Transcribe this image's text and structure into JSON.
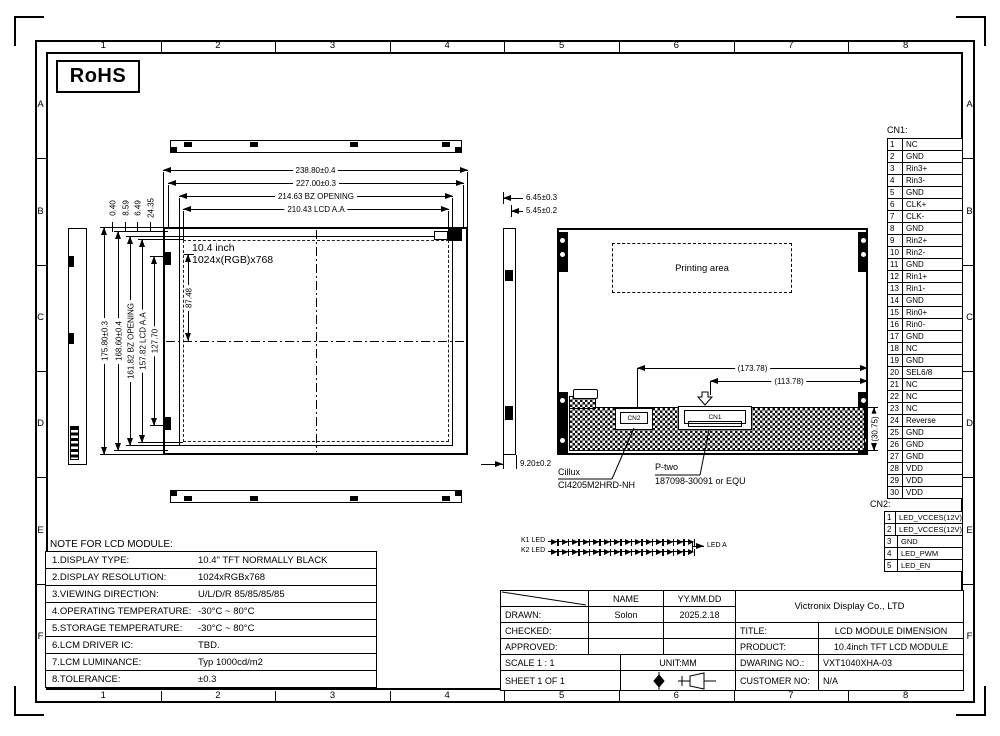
{
  "frame": {
    "cols": [
      "1",
      "2",
      "3",
      "4",
      "5",
      "6",
      "7",
      "8"
    ],
    "rows": [
      "A",
      "B",
      "C",
      "D",
      "E",
      "F"
    ]
  },
  "rohs": "RoHS",
  "front_view": {
    "panel_line1": "10.4 inch",
    "panel_line2": "1024x(RGB)x768",
    "dims_top": [
      "238.80±0.4",
      "227.00±0.3",
      "214.63 BZ OPENING",
      "210.43 LCD A.A"
    ],
    "dims_left": [
      "175.80±0.3",
      "168.60±0.4",
      "161.82 BZ OPENING",
      "157.82 LCD A.A",
      "127.70"
    ],
    "dims_top_small": [
      "0.40",
      "8.59",
      "6.49",
      "24.35"
    ],
    "dim_inner": "87.48"
  },
  "side_view": {
    "dim_top1": "6.45±0.3",
    "dim_top2": "5.45±0.2",
    "dim_bottom": "9.20±0.2"
  },
  "rear_view": {
    "printing_area": "Printing area",
    "dim_cn2": "(173.78)",
    "dim_cn1": "(113.78)",
    "dim_height": "(30.75)",
    "cn2_mark": "CN2",
    "cn1_mark": "CN1",
    "label_cn2_line1": "Cillux",
    "label_cn2_line2": "CI4205M2HRD-NH",
    "label_cn1_line1": "P-two",
    "label_cn1_line2": "187098-30091 or EQU"
  },
  "led_circuit": {
    "k1": "K1 LED",
    "k2": "K2 LED",
    "out": "LED A"
  },
  "cn1": {
    "title": "CN1:",
    "rows": [
      {
        "pin": "1",
        "signal": "NC"
      },
      {
        "pin": "2",
        "signal": "GND"
      },
      {
        "pin": "3",
        "signal": "Rin3+"
      },
      {
        "pin": "4",
        "signal": "Rin3-"
      },
      {
        "pin": "5",
        "signal": "GND"
      },
      {
        "pin": "6",
        "signal": "CLK+"
      },
      {
        "pin": "7",
        "signal": "CLK-"
      },
      {
        "pin": "8",
        "signal": "GND"
      },
      {
        "pin": "9",
        "signal": "Rin2+"
      },
      {
        "pin": "10",
        "signal": "Rin2-"
      },
      {
        "pin": "11",
        "signal": "GND"
      },
      {
        "pin": "12",
        "signal": "Rin1+"
      },
      {
        "pin": "13",
        "signal": "Rin1-"
      },
      {
        "pin": "14",
        "signal": "GND"
      },
      {
        "pin": "15",
        "signal": "Rin0+"
      },
      {
        "pin": "16",
        "signal": "Rin0-"
      },
      {
        "pin": "17",
        "signal": "GND"
      },
      {
        "pin": "18",
        "signal": "NC"
      },
      {
        "pin": "19",
        "signal": "GND"
      },
      {
        "pin": "20",
        "signal": "SEL6/8"
      },
      {
        "pin": "21",
        "signal": "NC"
      },
      {
        "pin": "22",
        "signal": "NC"
      },
      {
        "pin": "23",
        "signal": "NC"
      },
      {
        "pin": "24",
        "signal": "Reverse"
      },
      {
        "pin": "25",
        "signal": "GND"
      },
      {
        "pin": "26",
        "signal": "GND"
      },
      {
        "pin": "27",
        "signal": "GND"
      },
      {
        "pin": "28",
        "signal": "VDD"
      },
      {
        "pin": "29",
        "signal": "VDD"
      },
      {
        "pin": "30",
        "signal": "VDD"
      }
    ]
  },
  "cn2": {
    "title": "CN2:",
    "rows": [
      {
        "pin": "1",
        "signal": "LED_VCCES(12V)"
      },
      {
        "pin": "2",
        "signal": "LED_VCCES(12V)"
      },
      {
        "pin": "3",
        "signal": "GND"
      },
      {
        "pin": "4",
        "signal": "LED_PWM"
      },
      {
        "pin": "5",
        "signal": "LED_EN"
      }
    ]
  },
  "notes": {
    "title": "NOTE FOR LCD MODULE:",
    "rows": [
      {
        "label": "1.DISPLAY TYPE:",
        "value": "10.4\" TFT NORMALLY BLACK"
      },
      {
        "label": "2.DISPLAY RESOLUTION:",
        "value": "1024xRGBx768"
      },
      {
        "label": "3.VIEWING DIRECTION:",
        "value": "U/L/D/R 85/85/85/85"
      },
      {
        "label": "4.OPERATING TEMPERATURE:",
        "value": "-30°C ~ 80°C"
      },
      {
        "label": "5.STORAGE TEMPERATURE:",
        "value": "-30°C ~ 80°C"
      },
      {
        "label": "6.LCM DRIVER IC:",
        "value": "TBD."
      },
      {
        "label": "7.LCM LUMINANCE:",
        "value": "Typ 1000cd/m2"
      },
      {
        "label": "8.TOLERANCE:",
        "value": "±0.3"
      }
    ]
  },
  "title_block": {
    "name_header": "NAME",
    "date_header": "YY.MM.DD",
    "drawn_label": "DRAWN:",
    "drawn_name": "Solon",
    "drawn_date": "2025.2.18",
    "checked_label": "CHECKED:",
    "approved_label": "APPROVED:",
    "scale": "SCALE 1 : 1",
    "unit": "UNIT:MM",
    "sheet": "SHEET 1 OF 1",
    "company": "Victronix Display Co., LTD",
    "title_label": "TITLE:",
    "title_value": "LCD MODULE DIMENSION",
    "product_label": "PRODUCT:",
    "product_value": "10.4inch TFT LCD MODULE",
    "drawing_label": "DWARING NO.:",
    "drawing_value": "VXT1040XHA-03",
    "customer_label": "CUSTOMER NO:",
    "customer_value": "N/A"
  }
}
